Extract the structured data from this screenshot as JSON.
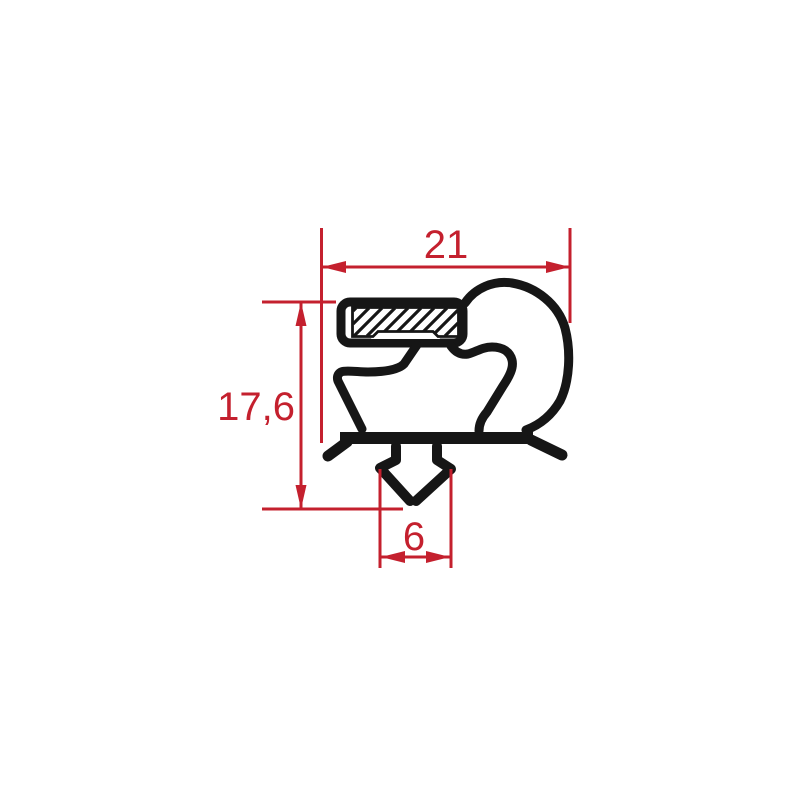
{
  "page": {
    "background": "#ffffff"
  },
  "drawing": {
    "profile_color": "#161616",
    "dimension_color": "#c4202e",
    "dimensions": {
      "width": {
        "label": "21"
      },
      "height": {
        "label": "17,6"
      },
      "dart_width": {
        "label": "6"
      }
    }
  }
}
